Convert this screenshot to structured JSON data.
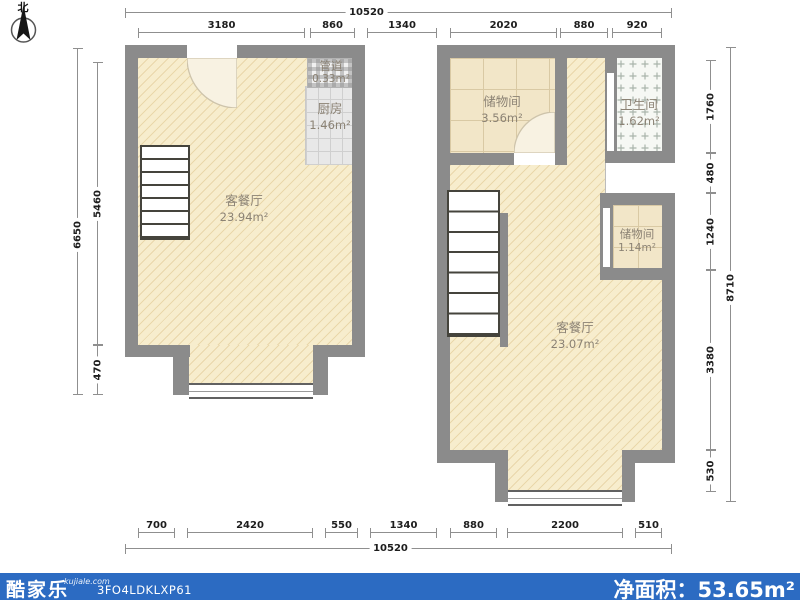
{
  "compass": {
    "north_label": "北"
  },
  "f1": {
    "rooms": [
      {
        "name": "客餐厅",
        "area": "23.94m²"
      },
      {
        "name": "厨房",
        "area": "1.46m²"
      },
      {
        "name": "管道",
        "area": "0.33m²"
      }
    ]
  },
  "f2": {
    "rooms": [
      {
        "name": "储物间",
        "area": "3.56m²"
      },
      {
        "name": "卫生间",
        "area": "1.62m²"
      },
      {
        "name": "储物间",
        "area": "1.14m²"
      },
      {
        "name": "客餐厅",
        "area": "23.07m²"
      }
    ]
  },
  "dims": {
    "top": {
      "total": "10520",
      "segments": [
        "3180",
        "860",
        "1340",
        "2020",
        "880",
        "920"
      ]
    },
    "bottom": {
      "total": "10520",
      "segments": [
        "700",
        "2420",
        "550",
        "1340",
        "880",
        "2200",
        "510"
      ]
    },
    "left": {
      "total": "6650",
      "segments": [
        "5460",
        "470"
      ]
    },
    "right": {
      "total": "8710",
      "segments": [
        "1760",
        "480",
        "1240",
        "3380",
        "530"
      ]
    }
  },
  "footer": {
    "brand": "酷家乐",
    "site": "kujiale.com",
    "plan_code": "3FO4LDKLXP61",
    "net_area_label": "净面积：",
    "net_area_value": "53.65m²"
  },
  "colors": {
    "wall": "#8b8b8b",
    "floor_fill": "#f7edcd",
    "footer_blue": "#2c6bc2"
  }
}
